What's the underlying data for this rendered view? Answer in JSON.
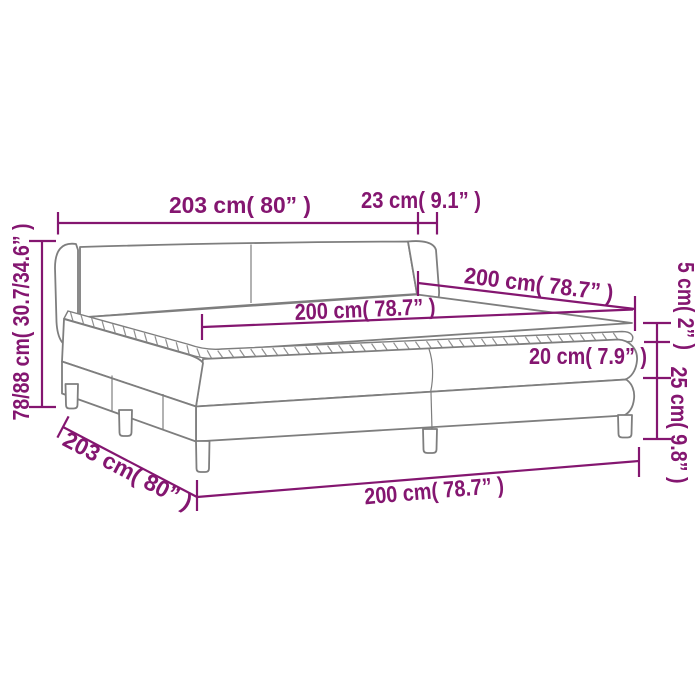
{
  "meta": {
    "type": "product-dimension-diagram",
    "subject": "box spring bed with headboard, two-part base, mattress and topper"
  },
  "colors": {
    "accent": "#841670",
    "line": "#7e7e7e",
    "background": "#ffffff"
  },
  "labels": {
    "headboard_width": "203 cm( 80” )",
    "headboard_depth": "23 cm( 9.1” )",
    "height_range": "78/88 cm( 30.7/34.6” )",
    "length_right": "200 cm( 78.7” )",
    "length_surface": "200 cm( 78.7” )",
    "topper_height": "5 cm( 2” )",
    "mattress_height": "20 cm( 7.9” )",
    "base_height": "25 cm( 9.8” )",
    "frame_width_side": "203 cm( 80” )",
    "length_bottom": "200 cm( 78.7” )"
  }
}
